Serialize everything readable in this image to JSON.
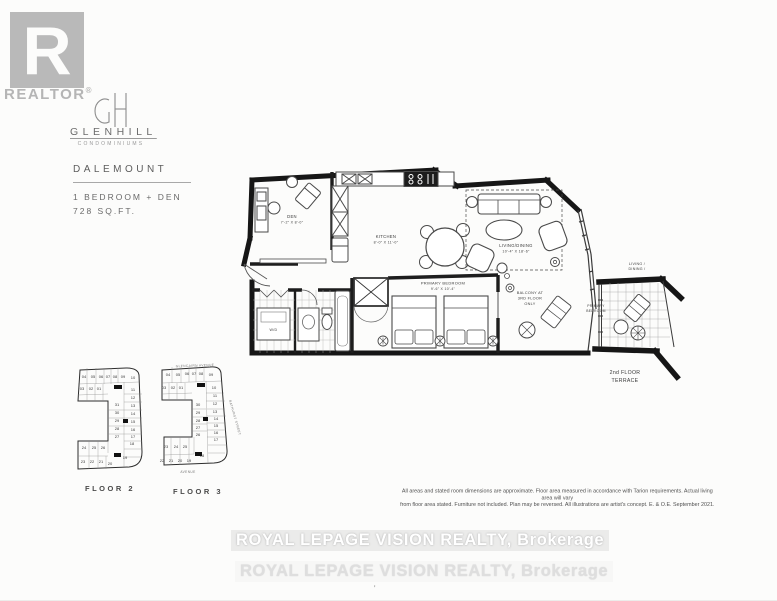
{
  "branding": {
    "realtor_mark": "R",
    "realtor_label": "REALTOR",
    "realtor_reg": "®",
    "logo_monogram": "GH",
    "building_name": "GLENHILL",
    "building_tagline": "CONDOMINIUMS",
    "logo_gray": "#b7b7b7"
  },
  "unit": {
    "model": "DALEMOUNT",
    "layout": "1 BEDROOM + DEN",
    "area": "728 SQ.FT."
  },
  "floorplan": {
    "rooms": {
      "den": {
        "name": "DEN",
        "dims": "7'-2\" X 8'-0\""
      },
      "kitchen": {
        "name": "KITCHEN",
        "dims": "8'-0\" X 11'-0\""
      },
      "living": {
        "name": "LIVING/DINING",
        "dims": "10'-4\" X 18'-6\""
      },
      "bedroom": {
        "name": "PRIMARY BEDROOM",
        "dims": "9'-6\" X 10'-4\""
      }
    },
    "labels": {
      "laundry": "W/D",
      "balcony": [
        "BALCONY AT",
        "3RD FLOOR",
        "ONLY"
      ]
    }
  },
  "terrace": {
    "context_top": [
      "LIVING /",
      "DINING /"
    ],
    "context_left": [
      "PRIMARY",
      "BEDROOM"
    ],
    "title": [
      "2nd FLOOR",
      "TERRACE"
    ]
  },
  "keyplans": [
    {
      "title": "FLOOR 2",
      "units": [
        {
          "n": "04",
          "x": 14,
          "y": 12
        },
        {
          "n": "05",
          "x": 23,
          "y": 12
        },
        {
          "n": "06",
          "x": 31,
          "y": 12
        },
        {
          "n": "07",
          "x": 38,
          "y": 12
        },
        {
          "n": "08",
          "x": 45,
          "y": 12
        },
        {
          "n": "09",
          "x": 53,
          "y": 12
        },
        {
          "n": "10",
          "x": 63,
          "y": 13
        },
        {
          "n": "03",
          "x": 12,
          "y": 24
        },
        {
          "n": "02",
          "x": 21,
          "y": 24
        },
        {
          "n": "01",
          "x": 29,
          "y": 24
        },
        {
          "n": "11",
          "x": 63,
          "y": 25
        },
        {
          "n": "12",
          "x": 63,
          "y": 33
        },
        {
          "n": "13",
          "x": 63,
          "y": 41
        },
        {
          "n": "14",
          "x": 63,
          "y": 49
        },
        {
          "n": "15",
          "x": 63,
          "y": 57
        },
        {
          "n": "16",
          "x": 63,
          "y": 65
        },
        {
          "n": "17",
          "x": 63,
          "y": 72
        },
        {
          "n": "18",
          "x": 62,
          "y": 79
        },
        {
          "n": "31",
          "x": 47,
          "y": 40
        },
        {
          "n": "30",
          "x": 47,
          "y": 48
        },
        {
          "n": "29",
          "x": 47,
          "y": 56
        },
        {
          "n": "28",
          "x": 47,
          "y": 64
        },
        {
          "n": "27",
          "x": 47,
          "y": 72
        },
        {
          "n": "24",
          "x": 14,
          "y": 83
        },
        {
          "n": "25",
          "x": 24,
          "y": 83
        },
        {
          "n": "26",
          "x": 33,
          "y": 83
        },
        {
          "n": "23",
          "x": 13,
          "y": 97
        },
        {
          "n": "22",
          "x": 22,
          "y": 97
        },
        {
          "n": "21",
          "x": 31,
          "y": 97
        },
        {
          "n": "20",
          "x": 40,
          "y": 99
        },
        {
          "n": "19",
          "x": 55,
          "y": 93
        }
      ],
      "markers": [
        {
          "x": 44,
          "y": 19,
          "w": 8,
          "h": 4
        },
        {
          "x": 53,
          "y": 53,
          "w": 5,
          "h": 4
        },
        {
          "x": 44,
          "y": 87,
          "w": 7,
          "h": 4
        }
      ]
    },
    {
      "title": "FLOOR 3",
      "streets": [
        "GLENCAIRN AVENUE",
        "BATHURST STREET",
        "AVENUE"
      ],
      "units": [
        {
          "n": "04",
          "x": 18,
          "y": 13
        },
        {
          "n": "05",
          "x": 28,
          "y": 13
        },
        {
          "n": "06",
          "x": 37,
          "y": 12
        },
        {
          "n": "07",
          "x": 44,
          "y": 12
        },
        {
          "n": "08",
          "x": 51,
          "y": 12
        },
        {
          "n": "09",
          "x": 61,
          "y": 13
        },
        {
          "n": "03",
          "x": 14,
          "y": 26
        },
        {
          "n": "02",
          "x": 23,
          "y": 26
        },
        {
          "n": "01",
          "x": 31,
          "y": 26
        },
        {
          "n": "10",
          "x": 64,
          "y": 26
        },
        {
          "n": "11",
          "x": 65,
          "y": 34
        },
        {
          "n": "12",
          "x": 65,
          "y": 42
        },
        {
          "n": "13",
          "x": 65,
          "y": 50
        },
        {
          "n": "14",
          "x": 66,
          "y": 57
        },
        {
          "n": "15",
          "x": 66,
          "y": 64
        },
        {
          "n": "16",
          "x": 66,
          "y": 71
        },
        {
          "n": "17",
          "x": 66,
          "y": 78
        },
        {
          "n": "30",
          "x": 48,
          "y": 43
        },
        {
          "n": "29",
          "x": 48,
          "y": 51
        },
        {
          "n": "28",
          "x": 48,
          "y": 59
        },
        {
          "n": "27",
          "x": 48,
          "y": 66
        },
        {
          "n": "26",
          "x": 48,
          "y": 73
        },
        {
          "n": "23",
          "x": 16,
          "y": 85
        },
        {
          "n": "24",
          "x": 26,
          "y": 85
        },
        {
          "n": "25",
          "x": 35,
          "y": 85
        },
        {
          "n": "22",
          "x": 12,
          "y": 99
        },
        {
          "n": "21",
          "x": 21,
          "y": 99
        },
        {
          "n": "20",
          "x": 30,
          "y": 99
        },
        {
          "n": "19",
          "x": 39,
          "y": 99
        },
        {
          "n": "18",
          "x": 52,
          "y": 94
        }
      ],
      "markers": [
        {
          "x": 47,
          "y": 20,
          "w": 8,
          "h": 4
        },
        {
          "x": 53,
          "y": 54,
          "w": 5,
          "h": 4
        },
        {
          "x": 45,
          "y": 89,
          "w": 7,
          "h": 4
        }
      ]
    }
  ],
  "disclaimer": [
    "All areas and stated room dimensions are approximate. Floor area measured in accordance with Tarion requirements. Actual living area will vary",
    "from floor area stated. Furniture not included. Plan may be reversed. All illustrations are artist's concept. E. & O.E. September 2021."
  ],
  "watermark": [
    "ROYAL LEPAGE VISION REALTY, Brokerage",
    "ROYAL LEPAGE VISION REALTY, Brokerage"
  ],
  "footnote_mark": "ʼ"
}
